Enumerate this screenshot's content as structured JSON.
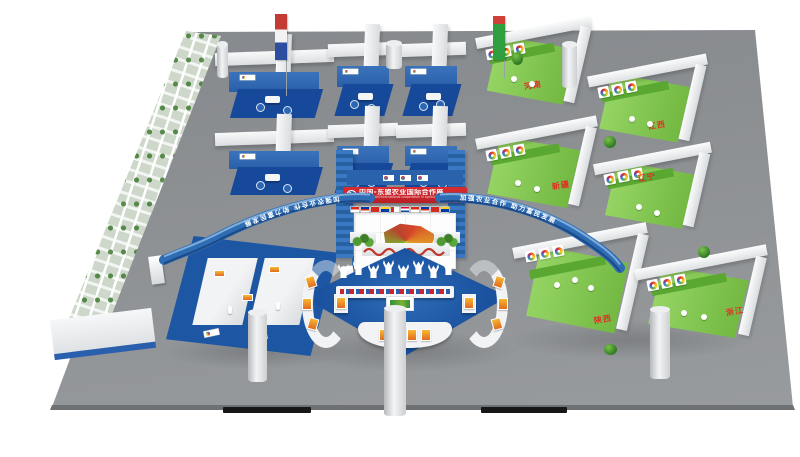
{
  "scene": {
    "name": "3D rendering of a China-ASEAN agricultural exhibition hall",
    "background_color": "#ffffff",
    "floor_color": "#8e9194"
  },
  "central_pavilion": {
    "banner_title": "中国-东盟农业国际合作展",
    "banner_subtitle": "China-ASEAN international cooperation in agriculture",
    "banner_color": "#c8242b",
    "mural": "china-produce-map-mural",
    "flag_row": "asean-member-flags"
  },
  "arches": {
    "slogan_left": "加强农业合作 助力富民发展",
    "slogan_right": "加强农业合作 助力富民发展",
    "color": "#2e6cb4"
  },
  "province_booths": [
    {
      "label": "河南"
    },
    {
      "label": "江西"
    },
    {
      "label": "新疆"
    },
    {
      "label": "辽宁"
    },
    {
      "label": "陕西"
    },
    {
      "label": "浙江"
    }
  ],
  "palette": {
    "booth_blue": "#1f5aa8",
    "booth_blue_dark": "#17499a",
    "booth_green": "#6db43c",
    "booth_green_light": "#9bd96a",
    "beam_white": "#f2f4f5",
    "label_red": "#e03126"
  }
}
